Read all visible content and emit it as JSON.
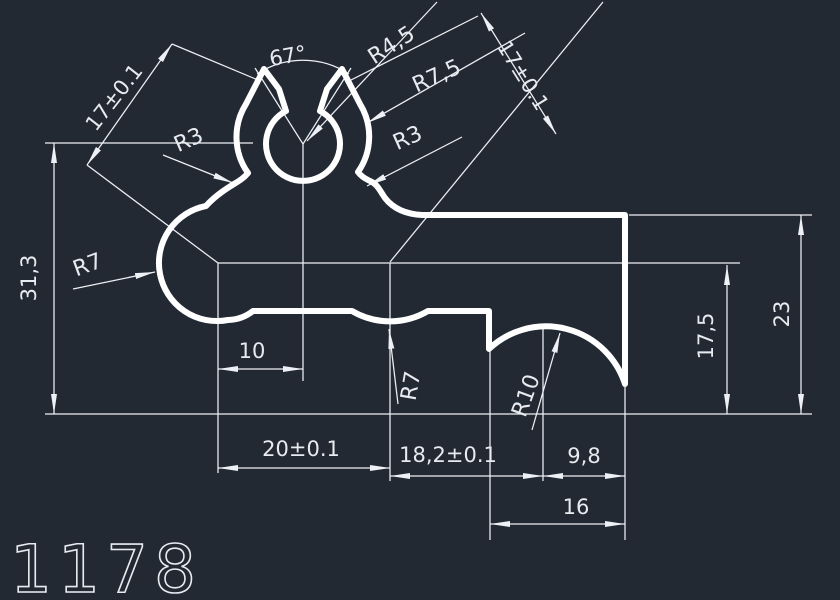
{
  "drawing": {
    "part_number": "1178",
    "labels": {
      "angle_67": "67°",
      "radius_4_5": "R4,5",
      "radius_7_5": "R7,5",
      "radius_3_right": "R3",
      "radius_3_left": "R3",
      "radius_7_left": "R7",
      "radius_7_valley": "R7",
      "radius_10": "R10",
      "dim_17_left": "17±0.1",
      "dim_17_right": "17±0.1",
      "dim_31_3": "31,3",
      "dim_10": "10",
      "dim_20": "20±0.1",
      "dim_18_2": "18,2±0.1",
      "dim_9_8": "9,8",
      "dim_16": "16",
      "dim_17_5": "17,5",
      "dim_23": "23"
    }
  },
  "colors": {
    "background": "#232933",
    "dimension_lines": "#edf0f4",
    "profile_outline": "#ffffff",
    "text": "#e7ebf0"
  }
}
